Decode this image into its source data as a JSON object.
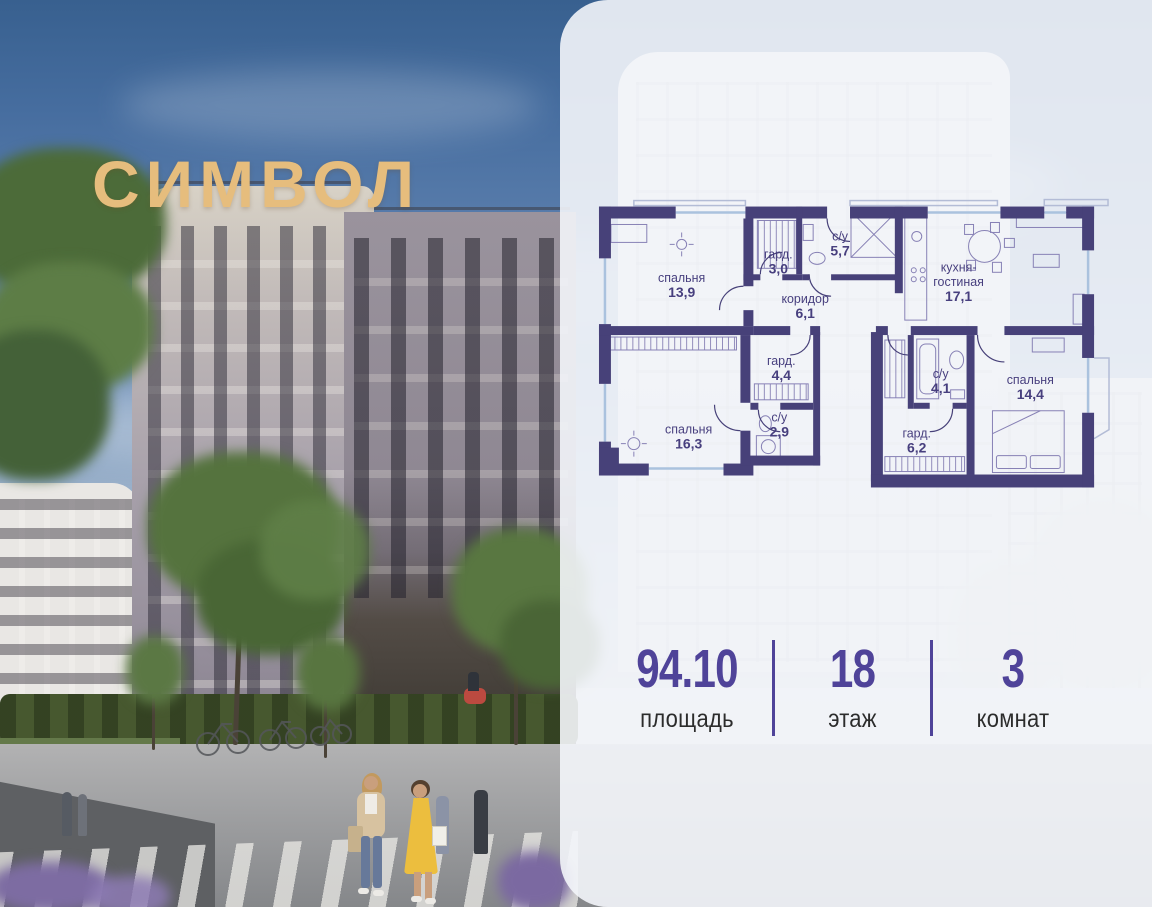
{
  "brand": {
    "name": "СИМВОЛ"
  },
  "colors": {
    "accent_indigo": "#4f4399",
    "plan_wall": "#474179",
    "brand_gold": "#e6bd7d"
  },
  "floor_plan": {
    "rooms": [
      {
        "id": "bedroom-1",
        "lines": [
          "спальня"
        ],
        "area": "13,9",
        "x": 88,
        "y": 84
      },
      {
        "id": "wardrobe-1",
        "lines": [
          "гард."
        ],
        "area": "3,0",
        "x": 185,
        "y": 60
      },
      {
        "id": "bathroom-1",
        "lines": [
          "с/у"
        ],
        "area": "5,7",
        "x": 247,
        "y": 42
      },
      {
        "id": "corridor",
        "lines": [
          "коридор"
        ],
        "area": "6,1",
        "x": 212,
        "y": 105
      },
      {
        "id": "kitchen-living",
        "lines": [
          "кухня-",
          "гостиная"
        ],
        "area": "17,1",
        "x": 366,
        "y": 73
      },
      {
        "id": "wardrobe-2",
        "lines": [
          "гард."
        ],
        "area": "4,4",
        "x": 188,
        "y": 167
      },
      {
        "id": "bathroom-2",
        "lines": [
          "с/у"
        ],
        "area": "2,9",
        "x": 186,
        "y": 224
      },
      {
        "id": "bedroom-2",
        "lines": [
          "спальня"
        ],
        "area": "16,3",
        "x": 95,
        "y": 236
      },
      {
        "id": "bathroom-3",
        "lines": [
          "с/у"
        ],
        "area": "4,1",
        "x": 348,
        "y": 180
      },
      {
        "id": "wardrobe-3",
        "lines": [
          "гард."
        ],
        "area": "6,2",
        "x": 324,
        "y": 240
      },
      {
        "id": "bedroom-3",
        "lines": [
          "спальня"
        ],
        "area": "14,4",
        "x": 438,
        "y": 186
      }
    ]
  },
  "stats": {
    "items": [
      {
        "value": "94.10",
        "label": "площадь"
      },
      {
        "value": "18",
        "label": "этаж"
      },
      {
        "value": "3",
        "label": "комнат"
      }
    ]
  }
}
